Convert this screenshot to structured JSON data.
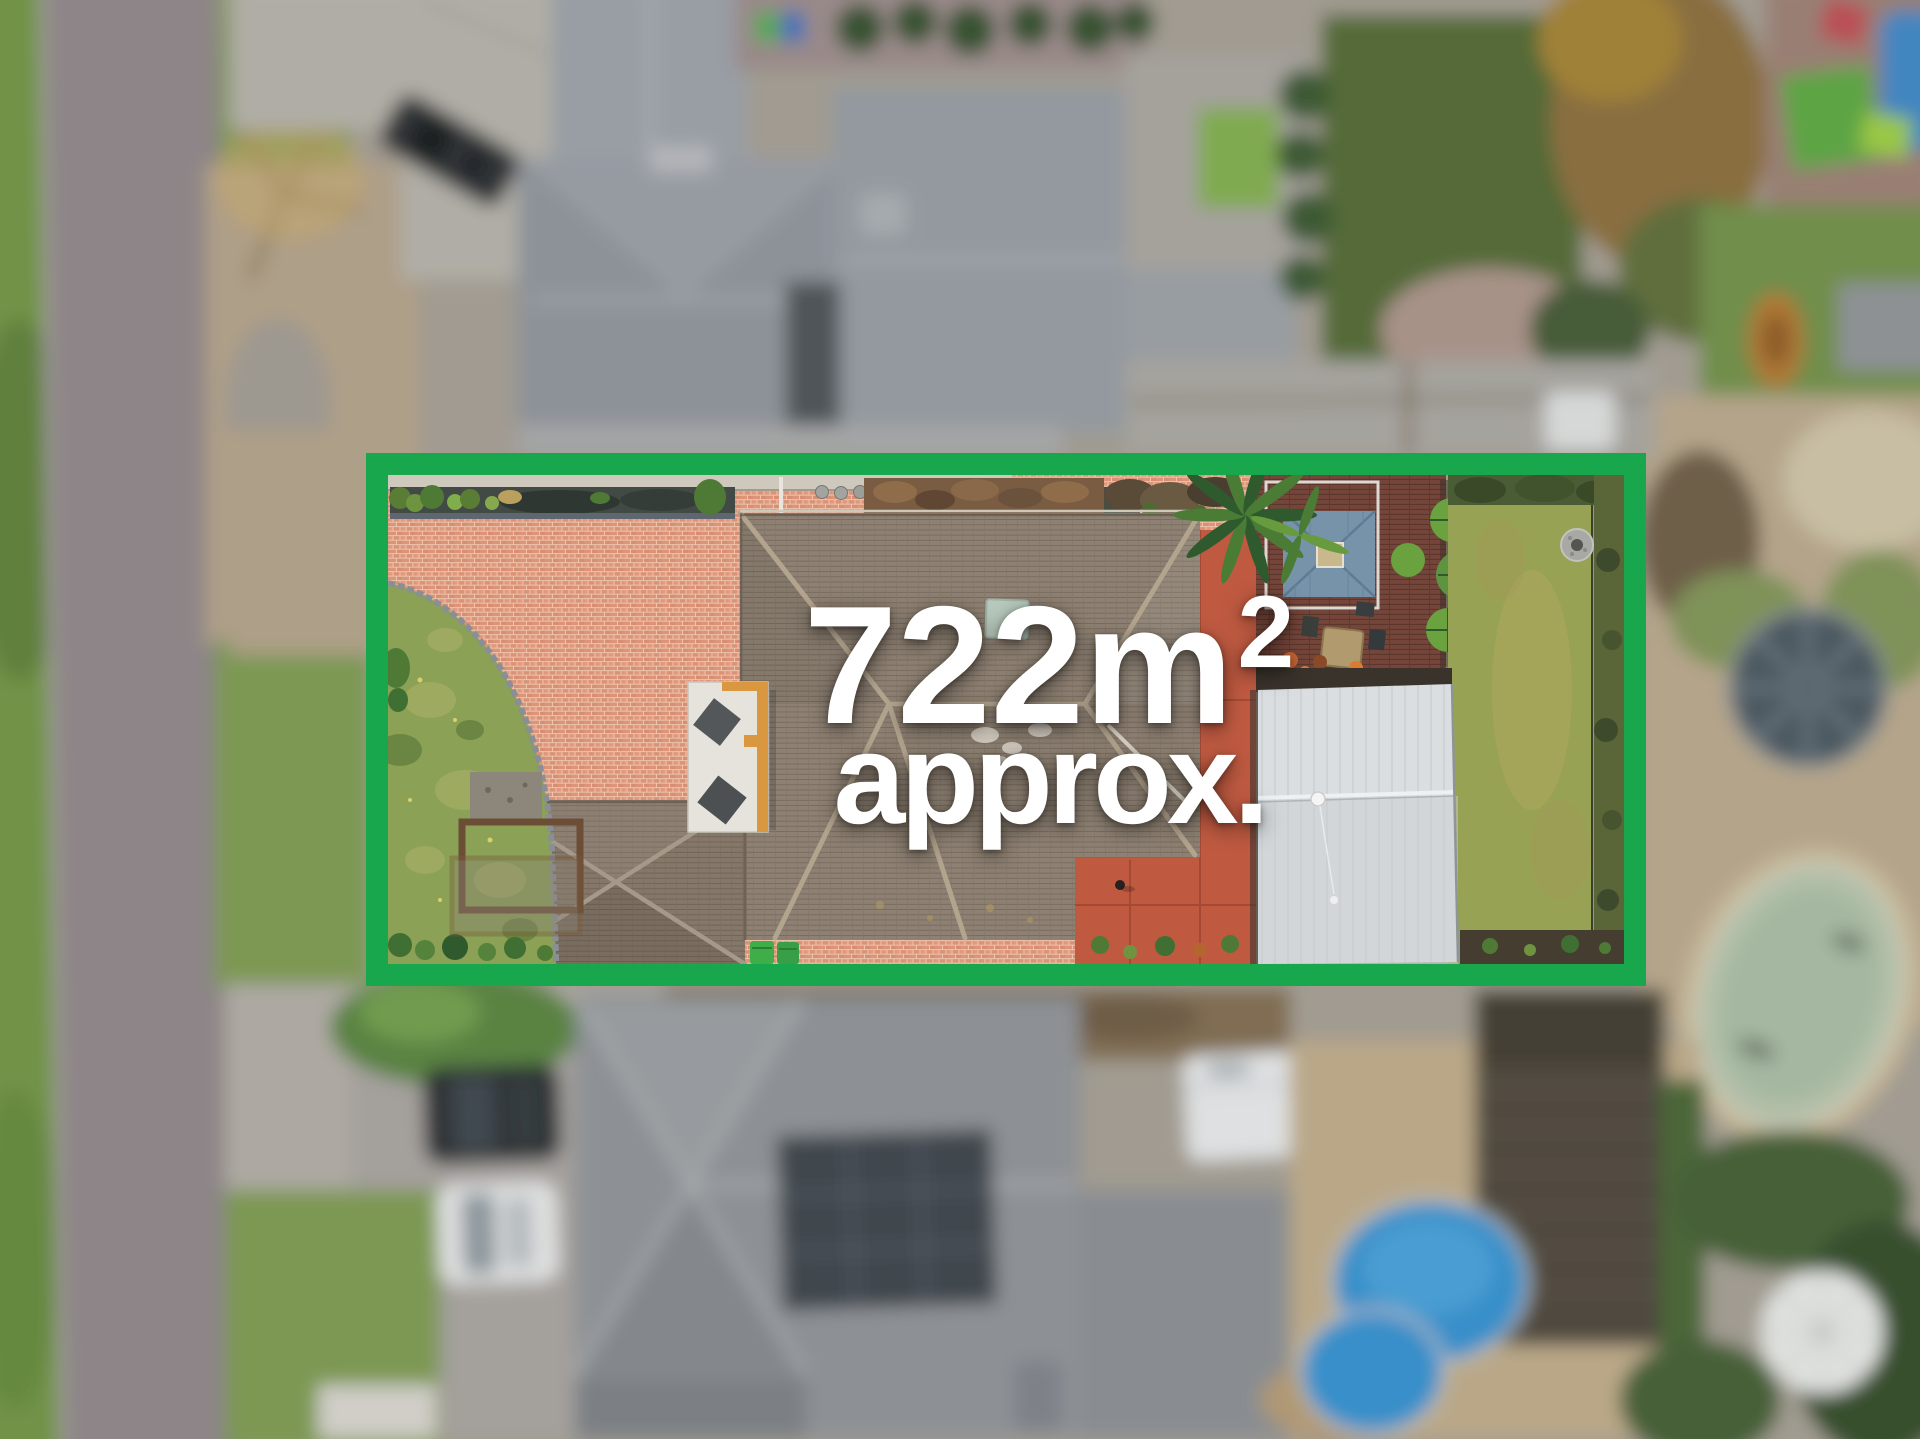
{
  "image": {
    "type": "aerial-drone-photograph",
    "subject": "suburban residential lot outlined for a real-estate listing"
  },
  "overlay": {
    "area_value": "722m",
    "area_exponent": "2",
    "qualifier": "approx.",
    "text_color": "#ffffff"
  },
  "boundary": {
    "stroke_color": "#18a74c"
  },
  "palette": {
    "brick_paving": "#dd9479",
    "red_court": "#bf5a41",
    "house_roof": "#8e8173",
    "garage_roof": "#857769",
    "front_lawn": "#8aa156",
    "back_lawn": "#97a254",
    "deck_timber": "#74453a",
    "gazebo_roof": "#7793aa",
    "shed_roof": "#d7dbdc",
    "road": "#8e8588",
    "grass_verge": "#6f9440",
    "neighbor_roofs": "#8e9298",
    "pool_blue": "#2f90d2",
    "pool_pebble": "#b7c6ae",
    "sand": "#bfab8a"
  }
}
